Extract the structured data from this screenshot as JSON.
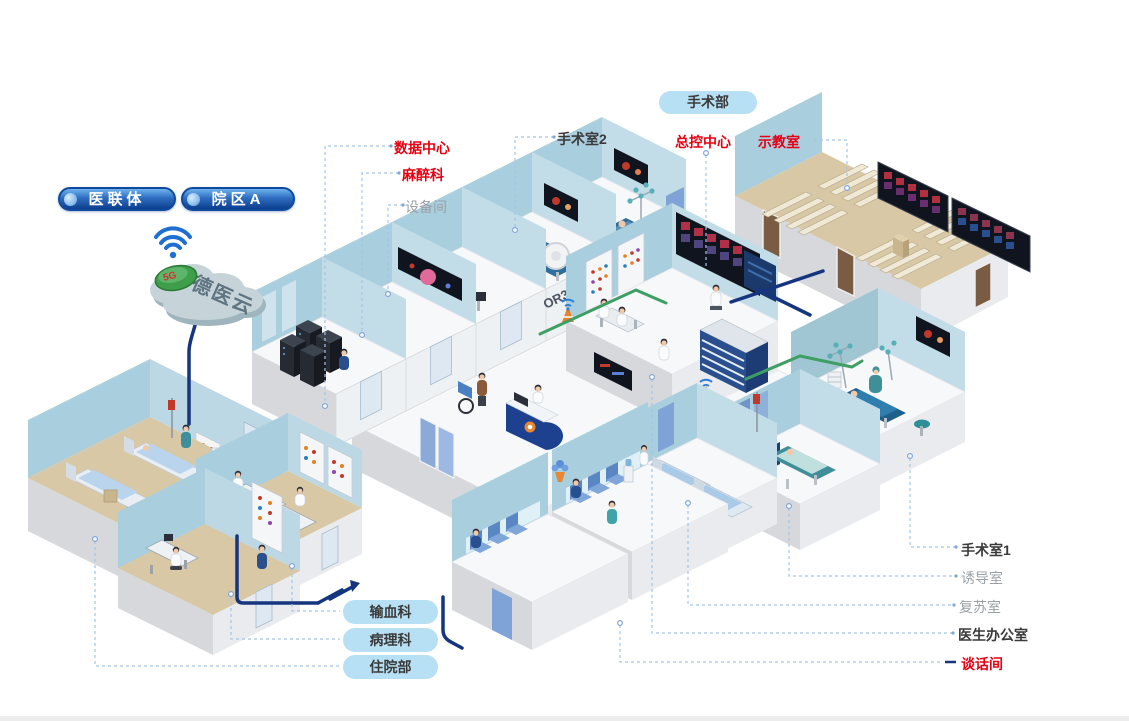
{
  "colors": {
    "red": "#e60012",
    "navy": "#16357f",
    "green": "#3f9e63",
    "light_blue_badge": "#b7e0f4",
    "org_badge_blue": "#0d3f8e",
    "callout_line": "#a6c4e4",
    "muted_text": "#9aa0a6",
    "dark_text": "#3a3a3a"
  },
  "cloud": {
    "label": "德医云",
    "badge": "5G"
  },
  "org_badges": [
    {
      "label": "医联体"
    },
    {
      "label": "院区A"
    }
  ],
  "department_badge": {
    "label": "手术部"
  },
  "callouts_top": [
    {
      "label": "数据中心",
      "emphasis": "red"
    },
    {
      "label": "麻醉科",
      "emphasis": "red"
    },
    {
      "label": "设备间",
      "emphasis": "muted"
    },
    {
      "label": "手术室2",
      "emphasis": "dark"
    },
    {
      "label": "总控中心",
      "emphasis": "red"
    },
    {
      "label": "示教室",
      "emphasis": "red"
    }
  ],
  "callouts_right": [
    {
      "label": "手术室1",
      "emphasis": "dark"
    },
    {
      "label": "诱导室",
      "emphasis": "muted"
    },
    {
      "label": "复苏室",
      "emphasis": "muted"
    },
    {
      "label": "医生办公室",
      "emphasis": "dark"
    },
    {
      "label": "谈话间",
      "emphasis": "red"
    }
  ],
  "bottom_pills": [
    {
      "label": "输血科"
    },
    {
      "label": "病理科"
    },
    {
      "label": "住院部"
    }
  ],
  "room_signs": {
    "or2": "OR2",
    "or3": "OR3"
  }
}
